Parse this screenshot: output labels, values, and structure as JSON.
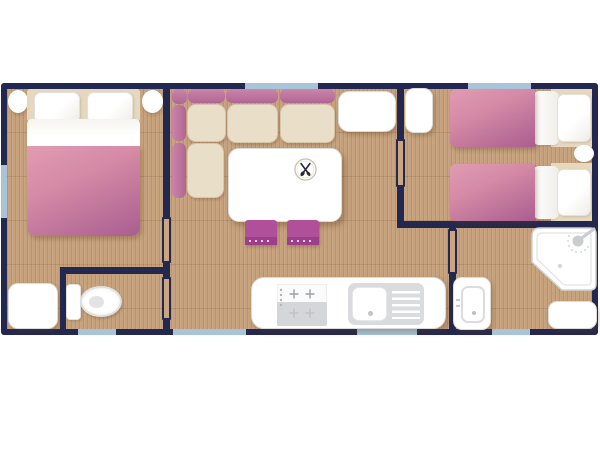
{
  "app": {
    "type": "floor-plan",
    "description": "Top-down floor plan of a mobile home with two bedrooms, living-dining area, kitchen, WC and shower room"
  },
  "palette": {
    "wall": "#232850",
    "floor": "#c6a17c",
    "floor_grain": "rgba(104,72,40,0.14)",
    "window": "#a9c4d9",
    "blanket_light": "#dd95ad",
    "blanket_dark": "#a95e90",
    "sofa_light": "#cc84a9",
    "sofa_dark": "#b06694",
    "cushion": "#e9dfc9",
    "headboard": "#e5d8bf",
    "stool": "#b1509a",
    "stool_stripe": "#9c3f8a",
    "fixture": "#ffffff",
    "fixture_border": "#dcdcdc",
    "appliance": "#d9dbde",
    "icon_dark": "#2b2b38"
  },
  "icons": [
    {
      "name": "cutlery-icon",
      "meaning": "crossed fork and spoon on a plate, marks the dining table"
    },
    {
      "name": "shower-head-icon",
      "meaning": "shower head with spray, marks the shower tray"
    }
  ],
  "rooms": [
    {
      "name": "master-bedroom",
      "furniture": [
        "double-bed",
        "bedside-stool",
        "bedside-stool",
        "wardrobe"
      ]
    },
    {
      "name": "wc",
      "furniture": [
        "toilet"
      ]
    },
    {
      "name": "living-room",
      "furniture": [
        "corner-sofa",
        "dining-table",
        "stool",
        "stool",
        "sideboard"
      ]
    },
    {
      "name": "kitchen",
      "furniture": [
        "stove",
        "sink-with-drainer",
        "counter"
      ]
    },
    {
      "name": "twin-bedroom",
      "furniture": [
        "single-bed",
        "single-bed",
        "nightstand",
        "wardrobe"
      ]
    },
    {
      "name": "shower-room",
      "furniture": [
        "shower-tray",
        "washbasin",
        "cabinet"
      ]
    }
  ]
}
